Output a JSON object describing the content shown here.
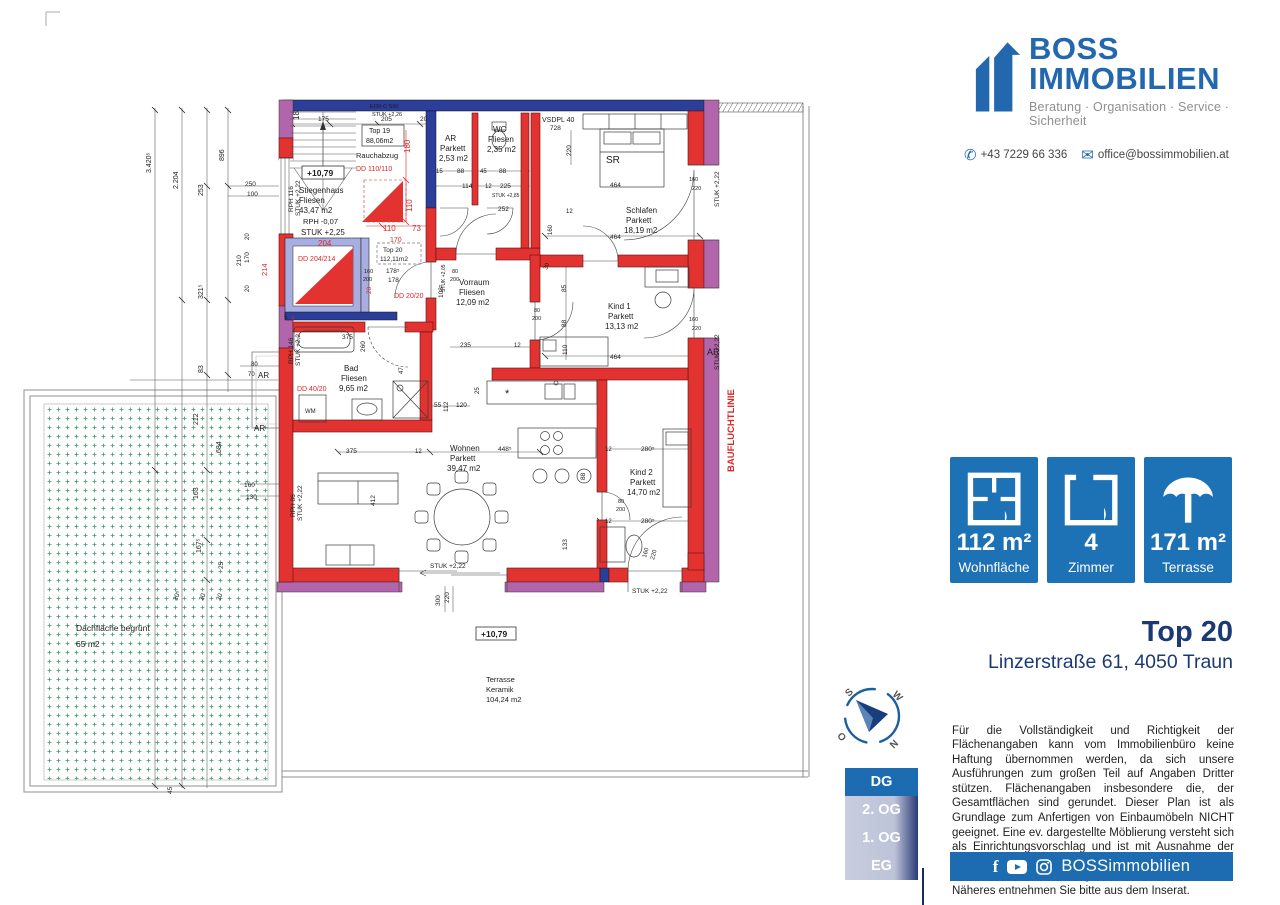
{
  "sidebar": {
    "logo": {
      "name1": "BOSS",
      "name2": "IMMOBILIEN",
      "tagline": "Beratung · Organisation · Service · Sicherheit"
    },
    "contact": {
      "phone": "+43 7229 66 336",
      "email": "office@bossimmobilien.at"
    },
    "stats": [
      {
        "value": "112 m²",
        "label": "Wohnfläche"
      },
      {
        "value": "4",
        "label": "Zimmer"
      },
      {
        "value": "171 m²",
        "label": "Terrasse"
      }
    ],
    "listing": {
      "title": "Top 20",
      "address": "Linzerstraße 61, 4050 Traun"
    },
    "disclaimer": "Für die Vollständigkeit und Richtigkeit der Flächenangaben kann vom Immobilienbüro keine Haftung übernommen werden, da sich unsere Ausführungen zum großen Teil auf Angaben Dritter stützen. Flächenangaben insbesondere die, der Gesamtflächen sind gerundet. Dieser Plan ist als Grundlage zum Anfertigen von Einbaumöbeln NICHT geeignet. Eine ev. dargestellte Möblierung versteht sich als Einrichtungsvorschlag und ist mit Ausnahme der Sanitärkeramik, Badewanne und/oder Duschanlage, bei Kauf oder Miete möglicherweise nicht inkludiert. Näheres entnehmen Sie bitte aus dem Inserat.",
    "footer": {
      "handle": "BOSSimmobilien"
    },
    "floors": [
      {
        "label": "DG"
      },
      {
        "label": "2. OG"
      },
      {
        "label": "1. OG"
      },
      {
        "label": "EG"
      }
    ],
    "compass": {
      "n": "N",
      "s": "S",
      "w": "W",
      "o": "O"
    }
  },
  "plan": {
    "labels": [
      {
        "t": "18",
        "x": 299,
        "y": 120,
        "r": -90,
        "s": 8
      },
      {
        "t": "175",
        "x": 318,
        "y": 121,
        "s": 6.5
      },
      {
        "t": "205",
        "x": 381,
        "y": 121,
        "s": 6.5
      },
      {
        "t": "20",
        "x": 420,
        "y": 121,
        "s": 6.5
      },
      {
        "t": "EI30-C S90",
        "x": 370,
        "y": 108,
        "s": 5.5
      },
      {
        "t": "STUK +2,26",
        "x": 372,
        "y": 116,
        "s": 5.5
      },
      {
        "t": "Top 19",
        "x": 369,
        "y": 133,
        "s": 7
      },
      {
        "t": "88,06m2",
        "x": 366,
        "y": 143,
        "s": 7
      },
      {
        "t": "Rauchabzug",
        "x": 356,
        "y": 158,
        "s": 7.5
      },
      {
        "t": "DD 110/110",
        "x": 356,
        "y": 171,
        "c": "r",
        "s": 7
      },
      {
        "t": "+10,79",
        "x": 307,
        "y": 176,
        "s": 8.5,
        "b": 1
      },
      {
        "t": "Stiegenhaus",
        "x": 299,
        "y": 193,
        "s": 8
      },
      {
        "t": "Fliesen",
        "x": 299,
        "y": 203,
        "s": 8
      },
      {
        "t": "43,47 m2",
        "x": 299,
        "y": 213,
        "s": 8
      },
      {
        "t": "RPH -0,07",
        "x": 303,
        "y": 224,
        "s": 7.5
      },
      {
        "t": "STUK +2,25",
        "x": 301,
        "y": 235,
        "s": 8
      },
      {
        "t": "204",
        "x": 318,
        "y": 246,
        "c": "r",
        "s": 8
      },
      {
        "t": "DD 204/214",
        "x": 298,
        "y": 261,
        "c": "r",
        "s": 7
      },
      {
        "t": "214",
        "x": 267,
        "y": 276,
        "r": -90,
        "c": "r",
        "s": 7.5
      },
      {
        "t": "180",
        "x": 410,
        "y": 153,
        "r": -90,
        "c": "r",
        "s": 8
      },
      {
        "t": "110",
        "x": 412,
        "y": 212,
        "r": -90,
        "c": "r",
        "s": 8
      },
      {
        "t": "110",
        "x": 383,
        "y": 231,
        "c": "r",
        "s": 8
      },
      {
        "t": "73",
        "x": 412,
        "y": 231,
        "c": "r",
        "s": 8
      },
      {
        "t": "170",
        "x": 390,
        "y": 242,
        "c": "r",
        "s": 7
      },
      {
        "t": "Top 20",
        "x": 383,
        "y": 252,
        "s": 6.5
      },
      {
        "t": "112,11m2",
        "x": 380,
        "y": 261,
        "s": 6.5
      },
      {
        "t": "178⁵",
        "x": 386,
        "y": 273,
        "s": 6.5
      },
      {
        "t": "178",
        "x": 388,
        "y": 282,
        "s": 6.5
      },
      {
        "t": "DD 20/20",
        "x": 394,
        "y": 298,
        "c": "r",
        "s": 7
      },
      {
        "t": "20",
        "x": 371,
        "y": 294,
        "r": -90,
        "c": "r",
        "s": 6.5
      },
      {
        "t": "160",
        "x": 364,
        "y": 273,
        "s": 5.5
      },
      {
        "t": "200",
        "x": 363,
        "y": 281,
        "s": 5.5
      },
      {
        "t": "RPH 116",
        "x": 293,
        "y": 212,
        "r": -90,
        "s": 6.5
      },
      {
        "t": "STUK +2,22",
        "x": 300,
        "y": 216,
        "r": -90,
        "s": 6.5
      },
      {
        "t": "250",
        "x": 245,
        "y": 186,
        "s": 6.5
      },
      {
        "t": "100",
        "x": 247,
        "y": 196,
        "s": 6.5
      },
      {
        "t": "210",
        "x": 241,
        "y": 266,
        "r": -90,
        "s": 6.5
      },
      {
        "t": "170",
        "x": 249,
        "y": 263,
        "r": -90,
        "s": 6.5
      },
      {
        "t": "20",
        "x": 249,
        "y": 240,
        "r": -90,
        "s": 6
      },
      {
        "t": "20",
        "x": 249,
        "y": 292,
        "r": -90,
        "s": 6
      },
      {
        "t": "5",
        "x": 284,
        "y": 319,
        "s": 6
      },
      {
        "t": "3",
        "x": 291,
        "y": 321,
        "c": "r",
        "s": 6
      },
      {
        "t": "3.420⁵",
        "x": 151,
        "y": 173,
        "r": -90,
        "s": 7
      },
      {
        "t": "2.204",
        "x": 178,
        "y": 189,
        "r": -90,
        "s": 7
      },
      {
        "t": "896",
        "x": 224,
        "y": 161,
        "r": -90,
        "s": 7
      },
      {
        "t": "253",
        "x": 203,
        "y": 196,
        "r": -90,
        "s": 7
      },
      {
        "t": "321⁵",
        "x": 203,
        "y": 299,
        "r": -90,
        "s": 7
      },
      {
        "t": "83",
        "x": 203,
        "y": 373,
        "r": -90,
        "s": 7
      },
      {
        "t": "80",
        "x": 251,
        "y": 366,
        "s": 6
      },
      {
        "t": "70",
        "x": 248,
        "y": 376,
        "s": 6
      },
      {
        "t": "AR",
        "x": 258,
        "y": 378,
        "s": 8
      },
      {
        "t": "AR",
        "x": 254,
        "y": 431,
        "s": 8
      },
      {
        "t": "212",
        "x": 198,
        "y": 425,
        "r": -90,
        "s": 7
      },
      {
        "t": "684",
        "x": 221,
        "y": 453,
        "r": -90,
        "s": 7
      },
      {
        "t": "163",
        "x": 198,
        "y": 499,
        "r": -90,
        "s": 7
      },
      {
        "t": "167⁵",
        "x": 201,
        "y": 553,
        "r": -90,
        "s": 7
      },
      {
        "t": "25",
        "x": 223,
        "y": 569,
        "r": -90,
        "s": 6.5
      },
      {
        "t": "160",
        "x": 244,
        "y": 487,
        "s": 6.5
      },
      {
        "t": "130",
        "x": 246,
        "y": 499,
        "s": 6.5
      },
      {
        "t": "20⁵",
        "x": 177,
        "y": 601,
        "r": -70,
        "s": 6.5
      },
      {
        "t": "20",
        "x": 203,
        "y": 601,
        "r": -70,
        "s": 6.5
      },
      {
        "t": "20",
        "x": 220,
        "y": 601,
        "r": -70,
        "s": 6.5
      },
      {
        "t": "45",
        "x": 172,
        "y": 794,
        "r": -90,
        "s": 6.5
      },
      {
        "t": "AR",
        "x": 445,
        "y": 141,
        "s": 8
      },
      {
        "t": "Parkett",
        "x": 440,
        "y": 151,
        "s": 8
      },
      {
        "t": "2,53 m2",
        "x": 439,
        "y": 161,
        "s": 8
      },
      {
        "t": "WC",
        "x": 493,
        "y": 132,
        "s": 8
      },
      {
        "t": "Fliesen",
        "x": 488,
        "y": 142,
        "s": 8
      },
      {
        "t": "2,35 m2",
        "x": 487,
        "y": 152,
        "s": 8
      },
      {
        "t": "VSDPL 40",
        "x": 542,
        "y": 122,
        "s": 7
      },
      {
        "t": "728",
        "x": 550,
        "y": 130,
        "s": 6.5
      },
      {
        "t": "15",
        "x": 436,
        "y": 173,
        "s": 6
      },
      {
        "t": "88",
        "x": 457,
        "y": 173,
        "s": 6.5
      },
      {
        "t": "45",
        "x": 480,
        "y": 173,
        "s": 6
      },
      {
        "t": "88",
        "x": 499,
        "y": 173,
        "s": 6.5
      },
      {
        "t": "114",
        "x": 462,
        "y": 188,
        "s": 6.5
      },
      {
        "t": "12",
        "x": 485,
        "y": 188,
        "s": 6
      },
      {
        "t": "225",
        "x": 500,
        "y": 188,
        "s": 6.5
      },
      {
        "t": "STUK +2,85",
        "x": 492,
        "y": 197,
        "s": 5
      },
      {
        "t": "252",
        "x": 498,
        "y": 211,
        "s": 6.5
      },
      {
        "t": "220",
        "x": 571,
        "y": 156,
        "r": -90,
        "s": 6.5
      },
      {
        "t": "SR",
        "x": 606,
        "y": 163,
        "s": 10
      },
      {
        "t": "464",
        "x": 610,
        "y": 187,
        "s": 6.5
      },
      {
        "t": "464",
        "x": 610,
        "y": 239,
        "s": 6.5
      },
      {
        "t": "12",
        "x": 566,
        "y": 213,
        "s": 6
      },
      {
        "t": "160",
        "x": 552,
        "y": 235,
        "r": -90,
        "s": 6
      },
      {
        "t": "Schlafen",
        "x": 626,
        "y": 213,
        "s": 8
      },
      {
        "t": "Parkett",
        "x": 626,
        "y": 223,
        "s": 8
      },
      {
        "t": "18,19 m2",
        "x": 624,
        "y": 233,
        "s": 8
      },
      {
        "t": "160",
        "x": 689,
        "y": 181,
        "s": 5.5
      },
      {
        "t": "220",
        "x": 692,
        "y": 190,
        "s": 5.5
      },
      {
        "t": "STUK +2,22",
        "x": 719,
        "y": 207,
        "r": -90,
        "s": 6.5
      },
      {
        "t": "Kind 1",
        "x": 608,
        "y": 309,
        "s": 8
      },
      {
        "t": "Parkett",
        "x": 608,
        "y": 319,
        "s": 8
      },
      {
        "t": "13,13 m2",
        "x": 605,
        "y": 329,
        "s": 8
      },
      {
        "t": "464",
        "x": 610,
        "y": 359,
        "s": 6.5
      },
      {
        "t": "85",
        "x": 566,
        "y": 292,
        "r": -90,
        "s": 6.5
      },
      {
        "t": "88",
        "x": 566,
        "y": 327,
        "r": -90,
        "s": 6.5
      },
      {
        "t": "110",
        "x": 567,
        "y": 355,
        "r": -90,
        "s": 6.5
      },
      {
        "t": "30",
        "x": 547,
        "y": 270,
        "r": -70,
        "s": 6
      },
      {
        "t": "80",
        "x": 534,
        "y": 312,
        "s": 5.5
      },
      {
        "t": "200",
        "x": 532,
        "y": 320,
        "s": 5.5
      },
      {
        "t": "160",
        "x": 689,
        "y": 321,
        "s": 5.5
      },
      {
        "t": "220",
        "x": 692,
        "y": 330,
        "s": 5.5
      },
      {
        "t": "STUK +2,22",
        "x": 719,
        "y": 370,
        "r": -90,
        "s": 6.5
      },
      {
        "t": "AR",
        "x": 707,
        "y": 355,
        "s": 9
      },
      {
        "t": "Vorraum",
        "x": 459,
        "y": 285,
        "s": 8
      },
      {
        "t": "Fliesen",
        "x": 459,
        "y": 295,
        "s": 8
      },
      {
        "t": "12,09 m2",
        "x": 456,
        "y": 305,
        "s": 8
      },
      {
        "t": "108⁵",
        "x": 443,
        "y": 298,
        "r": -90,
        "s": 6.5
      },
      {
        "t": "80",
        "x": 452,
        "y": 273,
        "s": 5.5
      },
      {
        "t": "200",
        "x": 450,
        "y": 281,
        "s": 5.5
      },
      {
        "t": "STUK +2,05",
        "x": 445,
        "y": 292,
        "r": -90,
        "s": 5
      },
      {
        "t": "235",
        "x": 460,
        "y": 347,
        "s": 6.5
      },
      {
        "t": "12",
        "x": 514,
        "y": 347,
        "s": 6
      },
      {
        "t": "Bad",
        "x": 344,
        "y": 371,
        "s": 8
      },
      {
        "t": "Fliesen",
        "x": 341,
        "y": 381,
        "s": 8
      },
      {
        "t": "9,65 m2",
        "x": 339,
        "y": 391,
        "s": 8
      },
      {
        "t": "DD 40/20",
        "x": 297,
        "y": 391,
        "c": "r",
        "s": 7
      },
      {
        "t": "WM",
        "x": 305,
        "y": 413,
        "s": 6
      },
      {
        "t": "260",
        "x": 365,
        "y": 352,
        "r": -90,
        "s": 6.5
      },
      {
        "t": "375",
        "x": 342,
        "y": 339,
        "s": 6.5
      },
      {
        "t": "47",
        "x": 403,
        "y": 374,
        "r": -90,
        "s": 6
      },
      {
        "t": "55",
        "x": 434,
        "y": 407,
        "s": 6.5
      },
      {
        "t": "112",
        "x": 448,
        "y": 412,
        "r": -90,
        "s": 6.5
      },
      {
        "t": "120",
        "x": 456,
        "y": 407,
        "s": 6.5
      },
      {
        "t": "25",
        "x": 479,
        "y": 394,
        "r": -90,
        "s": 6
      },
      {
        "t": "RPH 146",
        "x": 293,
        "y": 364,
        "r": -90,
        "s": 6.5
      },
      {
        "t": "STUK +2,2",
        "x": 300,
        "y": 366,
        "r": -90,
        "s": 6.5
      },
      {
        "t": "Wohnen",
        "x": 450,
        "y": 451,
        "s": 8
      },
      {
        "t": "Parkett",
        "x": 450,
        "y": 461,
        "s": 8
      },
      {
        "t": "39,47 m2",
        "x": 447,
        "y": 471,
        "s": 8
      },
      {
        "t": "375",
        "x": 346,
        "y": 453,
        "s": 6.5
      },
      {
        "t": "12",
        "x": 415,
        "y": 453,
        "s": 6
      },
      {
        "t": "448⁵",
        "x": 498,
        "y": 451,
        "s": 6.5
      },
      {
        "t": "412",
        "x": 375,
        "y": 506,
        "r": -90,
        "s": 6.5
      },
      {
        "t": "RPH 86",
        "x": 295,
        "y": 517,
        "r": -90,
        "s": 6.5
      },
      {
        "t": "STUK +2,22",
        "x": 302,
        "y": 521,
        "r": -90,
        "s": 6.5
      },
      {
        "t": "STUK +2,22",
        "x": 430,
        "y": 568,
        "s": 6.5
      },
      {
        "t": "300",
        "x": 440,
        "y": 606,
        "r": -90,
        "s": 6.5
      },
      {
        "t": "220",
        "x": 449,
        "y": 603,
        "r": -90,
        "s": 6.5
      },
      {
        "t": "*",
        "x": 505,
        "y": 397,
        "s": 11
      },
      {
        "t": "Kind 2",
        "x": 630,
        "y": 475,
        "s": 8
      },
      {
        "t": "Parkett",
        "x": 630,
        "y": 485,
        "s": 8
      },
      {
        "t": "14,70 m2",
        "x": 627,
        "y": 495,
        "s": 8
      },
      {
        "t": "280⁵",
        "x": 641,
        "y": 451,
        "s": 6.5
      },
      {
        "t": "280⁵",
        "x": 641,
        "y": 523,
        "s": 6.5
      },
      {
        "t": "12",
        "x": 605,
        "y": 451,
        "s": 6
      },
      {
        "t": "12",
        "x": 605,
        "y": 523,
        "s": 6
      },
      {
        "t": "80",
        "x": 618,
        "y": 503,
        "s": 5.5
      },
      {
        "t": "200",
        "x": 616,
        "y": 511,
        "s": 5.5
      },
      {
        "t": "88",
        "x": 585,
        "y": 480,
        "r": -90,
        "s": 6.5
      },
      {
        "t": "133",
        "x": 567,
        "y": 550,
        "r": -90,
        "s": 6.5
      },
      {
        "t": "160",
        "x": 646,
        "y": 558,
        "r": -75,
        "s": 6
      },
      {
        "t": "220",
        "x": 654,
        "y": 560,
        "r": -75,
        "s": 6
      },
      {
        "t": "STUK +2,22",
        "x": 632,
        "y": 593,
        "s": 6.5
      },
      {
        "t": "BAUFLUCHTLINIE",
        "x": 734,
        "y": 472,
        "r": -90,
        "c": "r",
        "s": 9.5,
        "b": 1
      },
      {
        "t": "+10,79",
        "x": 481,
        "y": 637,
        "s": 8.5,
        "b": 1
      },
      {
        "t": "Terrasse",
        "x": 486,
        "y": 682,
        "s": 7.5
      },
      {
        "t": "Keramik",
        "x": 486,
        "y": 692,
        "s": 7.5
      },
      {
        "t": "104,24 m2",
        "x": 486,
        "y": 702,
        "s": 7.5
      },
      {
        "t": "Dachfläche begrünt",
        "x": 76,
        "y": 631,
        "s": 8.5
      },
      {
        "t": "65 m2",
        "x": 76,
        "y": 647,
        "s": 8.5
      }
    ]
  }
}
